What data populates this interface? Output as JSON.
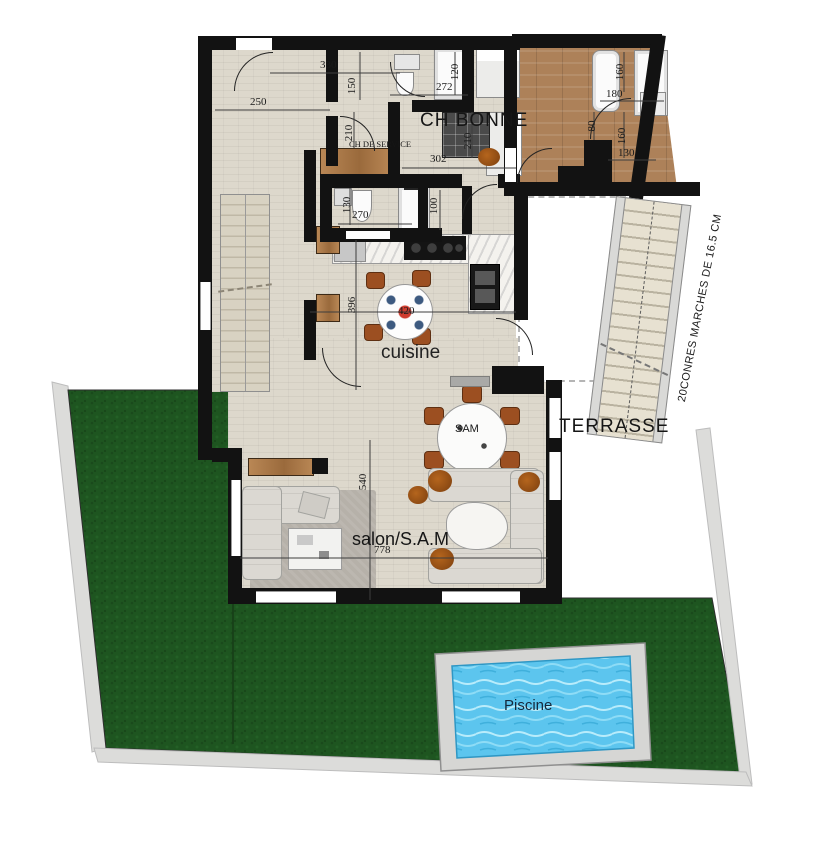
{
  "labels": {
    "ch_bonne": "CH BONNE",
    "ch_de_service": "CH DE SERVICE",
    "cuisine": "cuisine",
    "sam": "SAM",
    "terrasse": "TERRASSE",
    "salon": "salon/S.A.M",
    "piscine": "Piscine",
    "stairs_note": "20CONRES MARCHES DE 16.5 CM"
  },
  "dimensions": {
    "hall_330": "330",
    "hall_150": "150",
    "entry_250": "250",
    "bath1_272": "272",
    "bath1_120": "120",
    "service_210": "210",
    "bonne_210": "210",
    "bonne_302": "302",
    "bath2_160": "160",
    "bath2_180": "180",
    "landing_80": "80",
    "stairs_160": "160",
    "stairs_130": "130",
    "wc_130": "130",
    "wc_270": "270",
    "hall_100": "100",
    "kitchen_396": "396",
    "kitchen_420": "420",
    "salon_540": "540",
    "salon_778": "778"
  },
  "colors": {
    "wall": "#121212",
    "floor_tile": "#ddd8cc",
    "wood_floor": "#ad8159",
    "grass": "#1e5520",
    "path": "#dcdcda",
    "pool_water": "#5cc5ee",
    "pool_deck": "#d6d6d4"
  }
}
